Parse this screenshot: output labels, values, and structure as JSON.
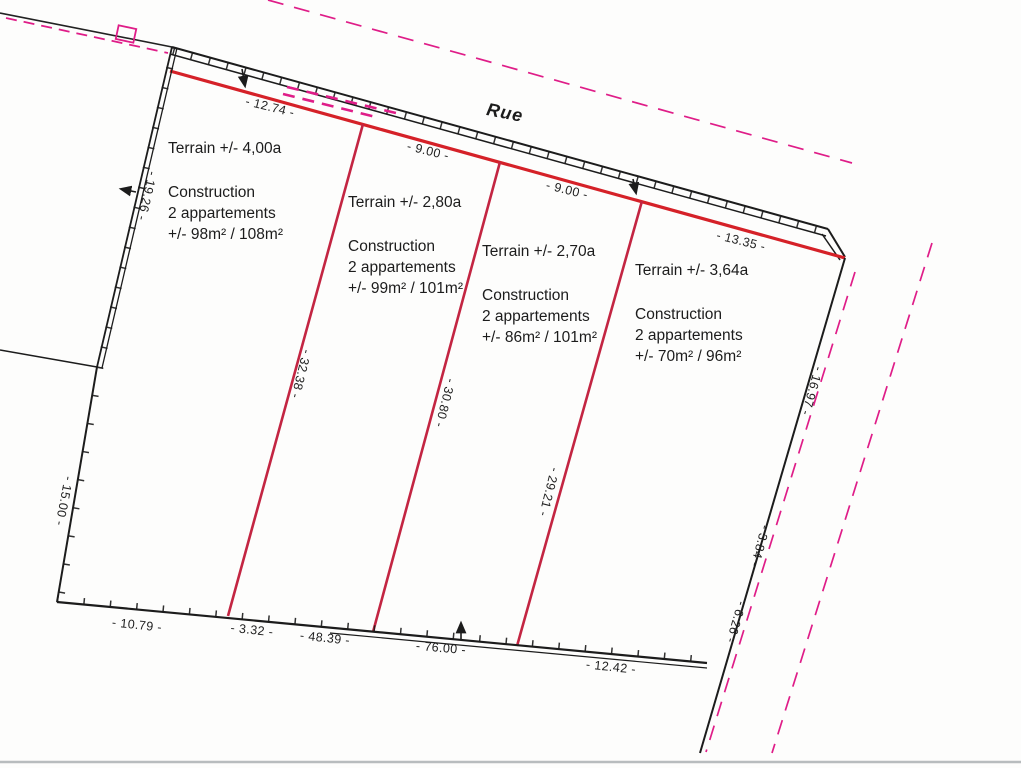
{
  "document": {
    "type_note": "cadastral division plan (scan)",
    "street_label": "Rue"
  },
  "colors": {
    "red_line": "#d52128",
    "divider_red": "#c32542",
    "magenta": "#df1d88",
    "black": "#1c1c1c",
    "scan_edge_grey": "#b8bcbe"
  },
  "parcels": [
    {
      "terrain": "Terrain +/- 4,00a",
      "construction": [
        "Construction",
        "2 appartements",
        "+/- 98m² / 108m²"
      ]
    },
    {
      "terrain": "Terrain +/- 2,80a",
      "construction": [
        "Construction",
        "2 appartements",
        "+/- 99m² / 101m²"
      ]
    },
    {
      "terrain": "Terrain +/- 2,70a",
      "construction": [
        "Construction",
        "2 appartements",
        "+/- 86m² / 101m²"
      ]
    },
    {
      "terrain": "Terrain +/- 3,64a",
      "construction": [
        "Construction",
        "2 appartements",
        "+/- 70m² / 96m²"
      ]
    }
  ],
  "measurements": {
    "street_frontage": [
      "- 12.74 -",
      "- 9.00 -",
      "- 9.00 -",
      "- 13.35 -"
    ],
    "left_side": [
      "- 19.26 -",
      "- 15.00 -"
    ],
    "bottom_side": [
      "- 10.79 -",
      "- 3.32 -",
      "- 48.39 -",
      "- 76.00 -",
      "- 12.42 -"
    ],
    "right_side": [
      "- 16.97 -",
      "- 3.84 -",
      "- 6.26 -"
    ],
    "parcel_dividers": [
      "- 32.38 -",
      "- 30.80 -",
      "- 29.21 -"
    ]
  }
}
